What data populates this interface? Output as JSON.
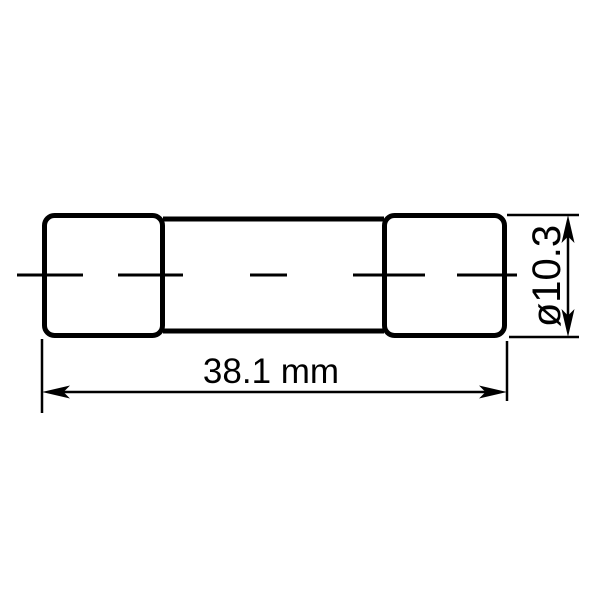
{
  "drawing": {
    "component": "cartridge-fuse",
    "labels": {
      "length": "38.1 mm",
      "diameter": "ø10.3"
    },
    "colors": {
      "line": "#000000",
      "background": "#ffffff"
    }
  }
}
